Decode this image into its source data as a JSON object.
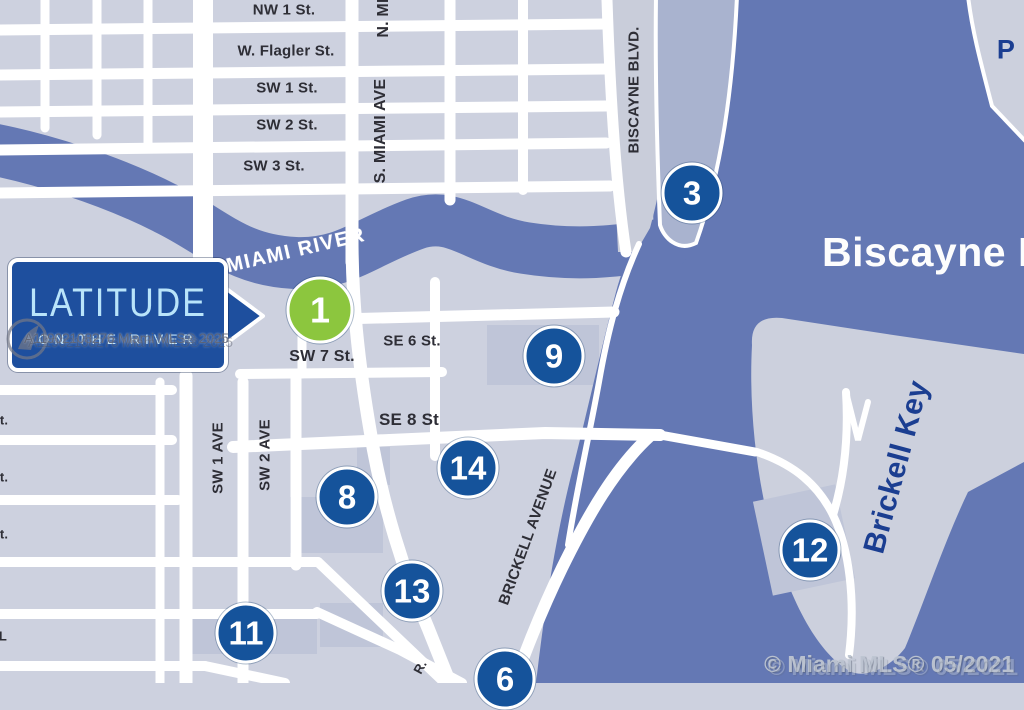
{
  "sign": {
    "title": "LATITUDE",
    "subtitle": "ON THE RIVER"
  },
  "water_labels": {
    "river": "MIAMI RIVER",
    "bay": "Biscayne B",
    "island": "Brickell Key",
    "port": "P"
  },
  "streets": {
    "nw1": "NW 1 St.",
    "flagler": "W. Flagler St.",
    "sw1st": "SW 1 St.",
    "sw2st": "SW 2 St.",
    "sw3st": "SW 3 St.",
    "nmiami": "N. MI",
    "smiami": "S. MIAMI AVE",
    "biscayne_blvd": "BISCAYNE BLVD.",
    "se6": "SE 6 St.",
    "sw7": "SW 7 St.",
    "se8": "SE 8 St",
    "sw1ave": "SW 1 AVE",
    "sw2ave": "SW 2 AVE",
    "brickell_ave": "BRICKELL AVENUE"
  },
  "edge_fragments": {
    "left1": "t.",
    "left2": "t.",
    "left3": "t.",
    "left4": "L",
    "bottom_diag": "R."
  },
  "markers": {
    "m1": "1",
    "m3": "3",
    "m6": "6",
    "m8": "8",
    "m9": "9",
    "m11": "11",
    "m12": "12",
    "m13": "13",
    "m14": "14"
  },
  "watermarks": {
    "listing_line": "A11902108276 Miami MLS® 2025",
    "copyright_line": "© Miami MLS® 05/2021"
  },
  "colors": {
    "water": "#6478b4",
    "land": "#cdd1df",
    "block_shade": "#bfc5d8",
    "pier_shade": "#a9b3cf",
    "road": "#ffffff",
    "marker_blue": "#15539b",
    "marker_green": "#8cc63e",
    "sign_blue": "#1e4f9e",
    "sign_text": "#b9e4fa",
    "navy_text": "#1b3e91",
    "street_text": "#2e2e36"
  }
}
